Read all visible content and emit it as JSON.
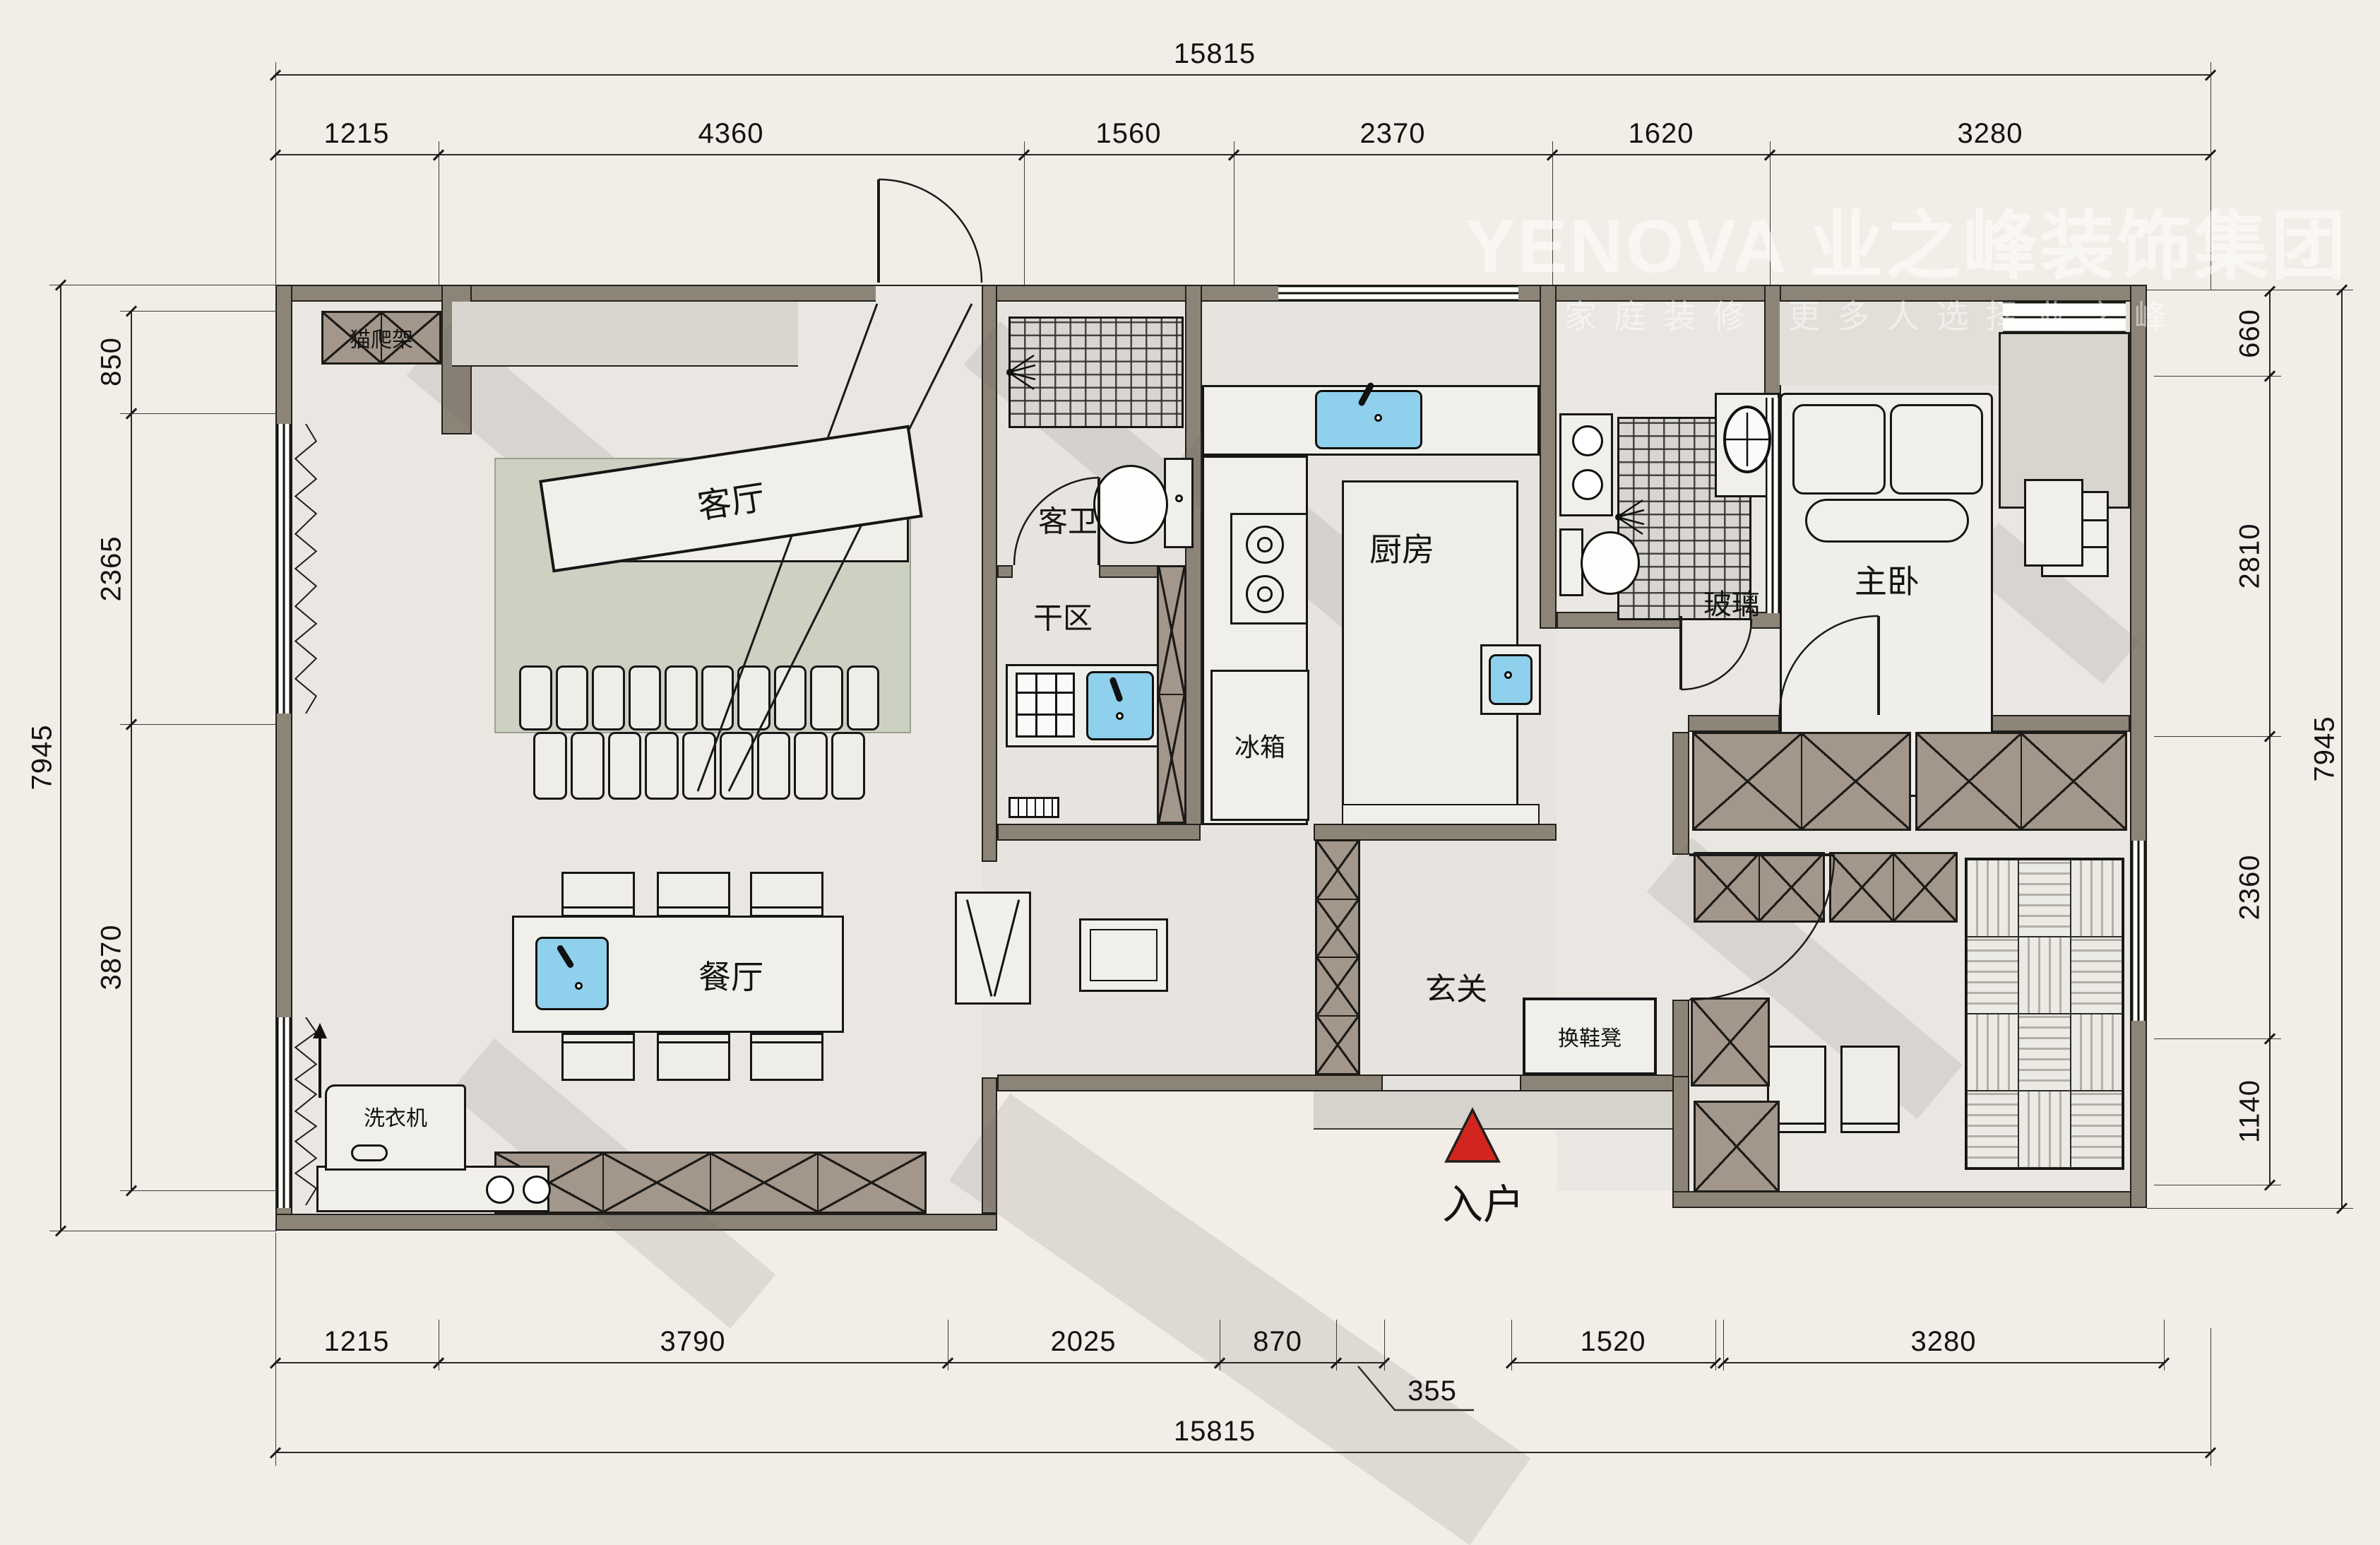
{
  "watermark": {
    "logo": "YENOVA",
    "brand": "业之峰装饰集团",
    "tagline": "家庭装修  更多人选择业之峰"
  },
  "dims": {
    "top_total": "15815",
    "top": [
      "1215",
      "4360",
      "1560",
      "2370",
      "1620",
      "3280"
    ],
    "bottom": [
      "1215",
      "3790",
      "2025",
      "870",
      "1520",
      "3280"
    ],
    "bottom_callout": "355",
    "bottom_total": "15815",
    "left": [
      "850",
      "2365",
      "3870"
    ],
    "left_total": "7945",
    "right": [
      "660",
      "2810",
      "2360",
      "1140"
    ],
    "right_total": "7945"
  },
  "labels": {
    "living": "客厅",
    "dining": "餐厅",
    "kitchen": "厨房",
    "guest_bath": "客卫",
    "dry_area": "干区",
    "fridge": "冰箱",
    "master_bedroom": "主卧",
    "glass": "玻璃",
    "foyer": "玄关",
    "shoe_bench": "换鞋凳",
    "washer": "洗衣机",
    "cat_tree": "猫爬架",
    "entry": "入户"
  },
  "colors": {
    "wall": "#8d8478",
    "floor": "#eae7e2",
    "cabinet": "#a3968a",
    "rug": "#cdd1c2",
    "accent_blue": "#8fd1ec",
    "entry_red": "#d3251f"
  }
}
